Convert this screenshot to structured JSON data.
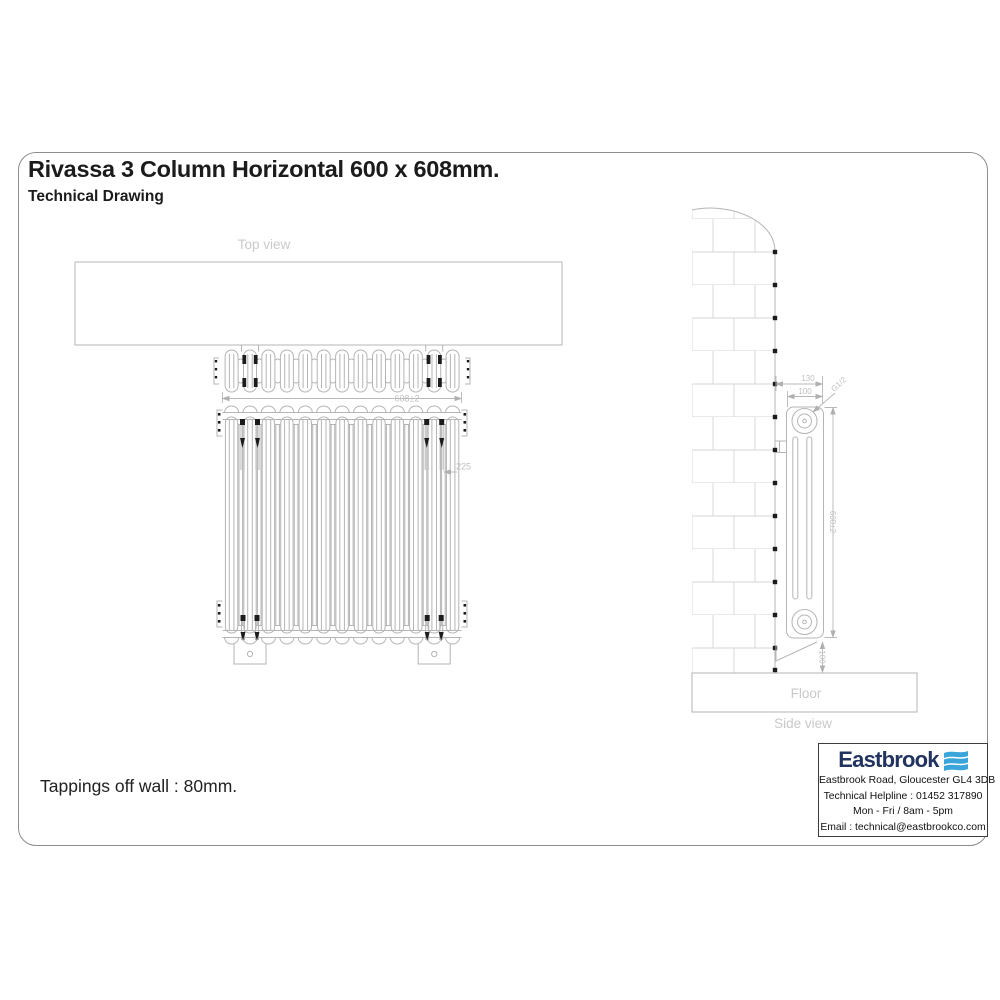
{
  "page": {
    "title": "Rivassa 3 Column Horizontal 600 x 608mm.",
    "subtitle": "Technical Drawing",
    "tappings_note": "Tappings off wall : 80mm."
  },
  "top_view": {
    "label": "Top view",
    "width_dim": "608±2"
  },
  "front_view": {
    "bracket_dim": "225"
  },
  "side_view": {
    "label": "Side view",
    "floor_label": "Floor",
    "wall_to_front_dim": "130",
    "depth_dim": "100",
    "tapping_size": "G1/2",
    "height_dim": "600±2",
    "floor_clearance_dim": "100"
  },
  "info_box": {
    "brand": "Eastbrook",
    "address": "Eastbrook Road, Gloucester GL4 3DB",
    "helpline": "Technical Helpline : 01452 317890",
    "hours": "Mon - Fri / 8am - 5pm",
    "email": "Email : technical@eastbrookco.com"
  },
  "colors": {
    "line": "#b5b5b5",
    "light_label": "#c9c9c9",
    "accent_black": "#1c1c1c",
    "brand_navy": "#21335e",
    "brand_blue": "#3aa5da"
  }
}
